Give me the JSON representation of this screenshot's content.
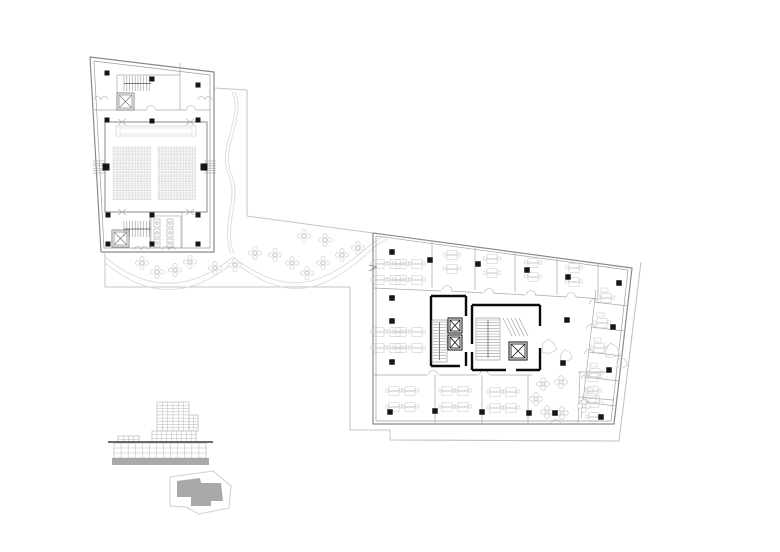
{
  "canvas": {
    "width": 780,
    "height": 552,
    "background": "#ffffff"
  },
  "colors": {
    "wall": "#8a8a8a",
    "wall_inner": "#9d9d9d",
    "partition": "#a8a8a8",
    "furniture": "#cfcfcf",
    "seat": "#c9c9c9",
    "column": "#161616",
    "core_wall": "#0a0a0a",
    "site_line": "#c6c6c6",
    "path_line": "#dcdcdc",
    "tree": "#d3d3d3",
    "elevation_line": "#b9b9b9",
    "ground_line": "#3c3c3c",
    "solid_gray": "#a9a9a9",
    "key_outline": "#d2d2d2",
    "key_fill": "#a9a9a9"
  },
  "plaza": {
    "upper_boundary": [
      [
        214,
        88
      ],
      [
        247,
        90
      ],
      [
        247,
        216
      ],
      [
        373,
        233
      ]
    ],
    "lower_boundary": [
      [
        105,
        253
      ],
      [
        105,
        287
      ],
      [
        350,
        287
      ],
      [
        350,
        430
      ],
      [
        390,
        430
      ],
      [
        390,
        440
      ],
      [
        619,
        441
      ],
      [
        641,
        262
      ]
    ],
    "paths": [
      "M232,92 C244,118 216,148 229,176 C239,198 220,226 231,254",
      "M235,92 C247,118 219,148 232,176 C242,198 223,226 234,254",
      "M104,256 C150,296 195,288 233,257 C280,292 310,290 352,260 C368,248 374,240 386,236",
      "M104,262 C152,303 196,294 234,262 C281,298 312,296 354,265 C370,252 376,243 388,239"
    ],
    "trees": [
      [
        142,
        263
      ],
      [
        157,
        272
      ],
      [
        175,
        270
      ],
      [
        190,
        262
      ],
      [
        215,
        268
      ],
      [
        235,
        265
      ],
      [
        255,
        253
      ],
      [
        275,
        255
      ],
      [
        292,
        263
      ],
      [
        307,
        273
      ],
      [
        323,
        263
      ],
      [
        342,
        255
      ],
      [
        304,
        236
      ],
      [
        325,
        240
      ],
      [
        358,
        248
      ]
    ]
  },
  "auditorium": {
    "outline": [
      [
        90,
        57
      ],
      [
        214,
        72
      ],
      [
        214,
        252
      ],
      [
        101,
        252
      ]
    ],
    "inner": [
      [
        94,
        61
      ],
      [
        210,
        75
      ],
      [
        210,
        248
      ],
      [
        104,
        248
      ]
    ],
    "columns": [
      [
        107,
        73,
        5
      ],
      [
        152,
        79,
        5
      ],
      [
        198,
        85,
        5
      ],
      [
        107,
        120,
        5
      ],
      [
        152,
        121,
        5
      ],
      [
        198,
        120,
        5
      ],
      [
        106,
        167,
        7
      ],
      [
        204,
        167,
        7
      ],
      [
        108,
        215,
        5
      ],
      [
        152,
        215,
        5
      ],
      [
        198,
        215,
        5
      ],
      [
        108,
        244,
        5
      ],
      [
        152,
        244,
        5
      ],
      [
        198,
        244,
        5
      ]
    ],
    "thin_lines": [
      [
        94,
        110,
        146,
        110
      ],
      [
        156,
        110,
        186,
        110
      ],
      [
        196,
        110,
        210,
        110
      ],
      [
        117,
        75,
        117,
        110
      ],
      [
        180,
        63,
        180,
        110
      ],
      [
        117,
        75,
        180,
        75
      ],
      [
        150,
        212,
        150,
        248
      ],
      [
        182,
        212,
        182,
        248
      ]
    ],
    "hall": {
      "rect": [
        105,
        122,
        207,
        212
      ],
      "stage": [
        116,
        126,
        196,
        136
      ],
      "rows": 12,
      "row_y0": 147,
      "row_dy": 4.5,
      "blocks": [
        [
          113,
          151
        ],
        [
          158,
          196
        ]
      ],
      "seat_gap": 3.0
    },
    "chevrons": [
      [
        122,
        122
      ],
      [
        190,
        122
      ],
      [
        122,
        212
      ],
      [
        190,
        212
      ]
    ],
    "stairs": [
      {
        "x0": 124,
        "x1": 151,
        "y0": 76,
        "y1": 91
      },
      {
        "x0": 124,
        "x1": 151,
        "y0": 221,
        "y1": 237
      }
    ],
    "elevators": [
      [
        117,
        93,
        134,
        110
      ],
      [
        112,
        230,
        129,
        247
      ]
    ],
    "toilets": {
      "room": [
        151,
        216,
        181,
        248
      ],
      "fixtures": [
        [
          154,
          219
        ],
        [
          154,
          229
        ],
        [
          154,
          239
        ],
        [
          167,
          219
        ],
        [
          167,
          229
        ],
        [
          167,
          239
        ]
      ]
    },
    "exit_hatch": [
      {
        "x0": 93,
        "x1": 105,
        "y0": 161
      },
      {
        "x0": 204,
        "x1": 216,
        "y0": 161
      }
    ],
    "door_pairs": [
      [
        101,
        100
      ],
      [
        205,
        100
      ],
      [
        141,
        250
      ],
      [
        169,
        250
      ]
    ],
    "door_arcs": [
      [
        151,
        110
      ],
      [
        191,
        110
      ]
    ]
  },
  "office": {
    "outline": [
      [
        373,
        233
      ],
      [
        632,
        268
      ],
      [
        614,
        424
      ],
      [
        373,
        424
      ]
    ],
    "inner": [
      [
        376,
        236
      ],
      [
        628,
        270
      ],
      [
        611,
        421
      ],
      [
        376,
        421
      ]
    ],
    "outer_site": [
      [
        390,
        440
      ],
      [
        619,
        441
      ],
      [
        641,
        262
      ]
    ],
    "columns": [
      [
        392,
        252,
        5.5
      ],
      [
        430,
        260,
        5.5
      ],
      [
        478,
        264,
        5.5
      ],
      [
        527,
        270,
        5.5
      ],
      [
        568,
        277,
        5.5
      ],
      [
        619,
        283,
        5.5
      ],
      [
        392,
        298,
        5.5
      ],
      [
        392,
        321,
        5.5
      ],
      [
        392,
        362,
        5.5
      ],
      [
        567,
        320,
        5.5
      ],
      [
        613,
        327,
        5.5
      ],
      [
        563,
        363,
        5.5
      ],
      [
        609,
        370,
        5.5
      ],
      [
        390,
        412,
        5.5
      ],
      [
        435,
        411,
        5.5
      ],
      [
        482,
        412,
        5.5
      ],
      [
        529,
        413,
        5.5
      ],
      [
        555,
        413,
        5.5
      ],
      [
        601,
        417,
        5.5
      ]
    ],
    "thin_lines": [
      [
        432,
        241,
        432,
        288
      ],
      [
        475,
        247,
        475,
        290
      ],
      [
        515,
        252,
        515,
        292
      ],
      [
        557,
        258,
        557,
        295
      ],
      [
        598,
        263,
        598,
        297
      ],
      [
        373,
        288,
        441,
        291
      ],
      [
        451,
        291,
        483,
        293
      ],
      [
        493,
        293,
        525,
        295
      ],
      [
        535,
        295,
        566,
        297
      ],
      [
        576,
        297,
        600,
        299
      ],
      [
        373,
        375,
        427,
        375
      ],
      [
        439,
        375,
        478,
        375
      ],
      [
        490,
        375,
        532,
        375
      ],
      [
        435,
        375,
        435,
        424
      ],
      [
        482,
        375,
        482,
        424
      ],
      [
        528,
        375,
        528,
        424
      ],
      [
        580,
        372,
        578,
        424
      ],
      [
        578,
        372,
        611,
        372
      ],
      [
        579,
        397,
        613,
        400
      ],
      [
        596,
        290,
        581,
        418
      ],
      [
        594,
        302,
        628,
        306
      ],
      [
        591,
        327,
        625,
        331
      ],
      [
        589,
        352,
        622,
        356
      ],
      [
        586,
        377,
        619,
        381
      ],
      [
        584,
        402,
        616,
        406
      ]
    ],
    "door_arcs": [
      [
        447,
        290
      ],
      [
        489,
        293
      ],
      [
        531,
        295
      ],
      [
        571,
        297
      ],
      [
        433,
        375
      ],
      [
        484,
        375
      ],
      [
        594,
        304
      ],
      [
        591,
        329
      ],
      [
        589,
        354
      ],
      [
        586,
        379
      ],
      [
        584,
        404
      ],
      [
        556,
        424
      ]
    ],
    "clusters4": [
      [
        387,
        272
      ],
      [
        409,
        272
      ],
      [
        387,
        340
      ],
      [
        409,
        340
      ],
      [
        402,
        399
      ],
      [
        455,
        399
      ],
      [
        503,
        400
      ]
    ],
    "room_desks": [
      [
        452,
        262
      ],
      [
        492,
        266
      ],
      [
        533,
        270
      ],
      [
        574,
        275
      ],
      [
        593,
        384
      ],
      [
        594,
        410
      ]
    ],
    "band_desks": [
      [
        606,
        298
      ],
      [
        602,
        323
      ],
      [
        599,
        348
      ],
      [
        595,
        373
      ],
      [
        591,
        398
      ]
    ],
    "core_left": {
      "thick": [
        [
          431,
          296,
          466,
          296
        ],
        [
          431,
          296,
          431,
          366
        ],
        [
          431,
          366,
          460,
          366
        ],
        [
          466,
          296,
          466,
          316
        ],
        [
          466,
          352,
          466,
          366
        ]
      ],
      "stair": [
        432,
        320,
        447,
        362
      ],
      "elevators": [
        [
          448,
          318,
          462,
          333
        ],
        [
          448,
          335,
          462,
          350
        ]
      ]
    },
    "core_right": {
      "thick": [
        [
          472,
          305,
          540,
          305
        ],
        [
          472,
          305,
          472,
          344
        ],
        [
          472,
          352,
          472,
          370
        ],
        [
          472,
          370,
          506,
          370
        ],
        [
          516,
          370,
          540,
          370
        ],
        [
          540,
          305,
          540,
          326
        ],
        [
          540,
          348,
          540,
          370
        ]
      ],
      "stair": [
        476,
        318,
        500,
        360
      ],
      "diag": [
        503,
        318,
        523,
        336
      ],
      "elevator": [
        509,
        342,
        527,
        360
      ]
    },
    "lounge_blobs": [
      [
        549,
        347,
        8
      ],
      [
        566,
        356,
        6.5
      ],
      [
        612,
        351,
        8
      ],
      [
        622,
        363,
        6
      ]
    ],
    "flowers": [
      [
        543,
        384
      ],
      [
        561,
        382
      ],
      [
        536,
        399
      ],
      [
        547,
        412
      ],
      [
        562,
        413
      ],
      [
        584,
        406
      ]
    ],
    "wall_break": [
      373,
      268
    ]
  },
  "elevation": {
    "tower": {
      "x0": 157,
      "y0": 402,
      "x1": 189,
      "y1": 431,
      "cols": 6,
      "rows": 9
    },
    "tower_step": {
      "x0": 189,
      "y0": 415,
      "x1": 198,
      "y1": 431,
      "cols": 2,
      "rows": 5
    },
    "tower_base": {
      "x0": 152,
      "y0": 431,
      "x1": 196,
      "y1": 442,
      "cols": 9,
      "rows": 3
    },
    "left_block": {
      "x0": 118,
      "y0": 436,
      "x1": 139,
      "y1": 443,
      "cols": 4,
      "rows": 2
    },
    "podium": {
      "x0": 114,
      "y0": 443,
      "x1": 206,
      "y1": 458,
      "cols": 13,
      "rows": 3
    },
    "ground": [
      108,
      442,
      213,
      442
    ],
    "base": [
      112,
      458,
      209,
      465
    ]
  },
  "keyplan": {
    "outline": [
      [
        170,
        477
      ],
      [
        213,
        471
      ],
      [
        231,
        486
      ],
      [
        229,
        508
      ],
      [
        199,
        514
      ],
      [
        186,
        507
      ],
      [
        170,
        506
      ]
    ],
    "footprint": [
      [
        177,
        481
      ],
      [
        200,
        478
      ],
      [
        201,
        483
      ],
      [
        221,
        483
      ],
      [
        223,
        501
      ],
      [
        211,
        501
      ],
      [
        211,
        506
      ],
      [
        191,
        506
      ],
      [
        191,
        497
      ],
      [
        177,
        497
      ]
    ]
  }
}
